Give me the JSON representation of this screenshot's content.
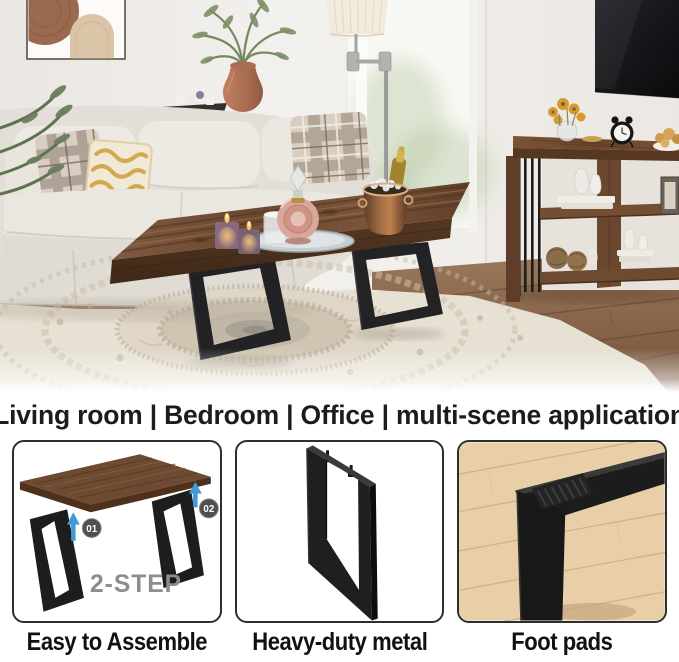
{
  "banner": {
    "text": "Living room | Bedroom | Office | multi-scene application"
  },
  "features": {
    "items": [
      {
        "id": "easy-to-assemble",
        "label": "Easy to Assemble",
        "diagram": {
          "step_label": "2-STEP",
          "step1_badge": "01",
          "step2_badge": "02"
        }
      },
      {
        "id": "heavy-duty-metal",
        "label": "Heavy-duty metal"
      },
      {
        "id": "foot-pads",
        "label": "Foot pads"
      }
    ]
  },
  "colors": {
    "arrow_accent": "#3f9ad6",
    "step_text": "#8d8d8d",
    "panel_border": "#2e2e2e",
    "table_wood": "#6f4a33",
    "metal_black": "#1e1e1e",
    "sofa_cream": "#e8e4dd",
    "rug_ivory": "#e7e1d4",
    "floor_brown": "#8a6750",
    "banner_text": "#1c1c1c"
  },
  "scene": {
    "elements": [
      "wall-art",
      "potted-plant",
      "serving-tray",
      "sofa",
      "throw-pillows",
      "floor-lamp",
      "window",
      "tv",
      "console-table",
      "sunflower-vase",
      "alarm-clock",
      "bread-plate",
      "decor-vases",
      "books",
      "picture-frame",
      "rattan-balls",
      "coffee-table",
      "candles",
      "water-glass",
      "perfume-decanter",
      "mirror-tray",
      "ice-bucket",
      "champagne-bottle",
      "area-rug",
      "wood-floor"
    ]
  }
}
